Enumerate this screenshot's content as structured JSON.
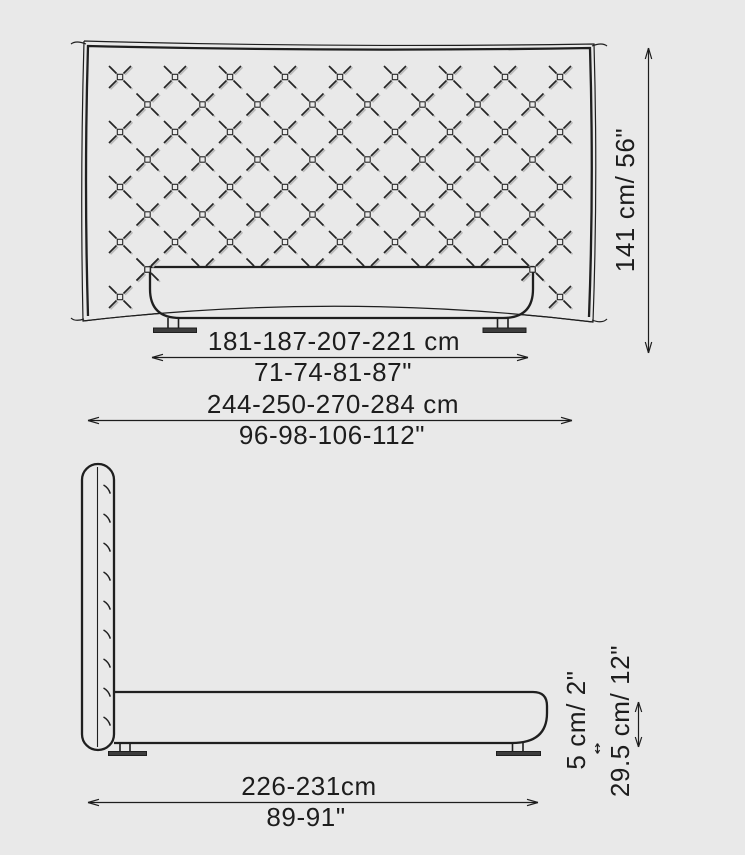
{
  "colors": {
    "background": "#e9e9e9",
    "line": "#1f1f1f",
    "thin_line": "#2a2a2a",
    "pattern_shadow": "#b9b9b9",
    "foot_fill": "#3d3d3d"
  },
  "front_view": {
    "bed_width_cm": "181-187-207-221 cm",
    "bed_width_in": "71-74-81-87\"",
    "overall_width_cm": "244-250-270-284 cm",
    "overall_width_in": "96-98-106-112\"",
    "height_label": "141 cm/ 56\""
  },
  "side_view": {
    "depth_cm": "226-231cm",
    "depth_in": "89-91\"",
    "leg_height_label": "5 cm/ 2\"",
    "total_height_label": "29.5 cm/ 12\""
  }
}
